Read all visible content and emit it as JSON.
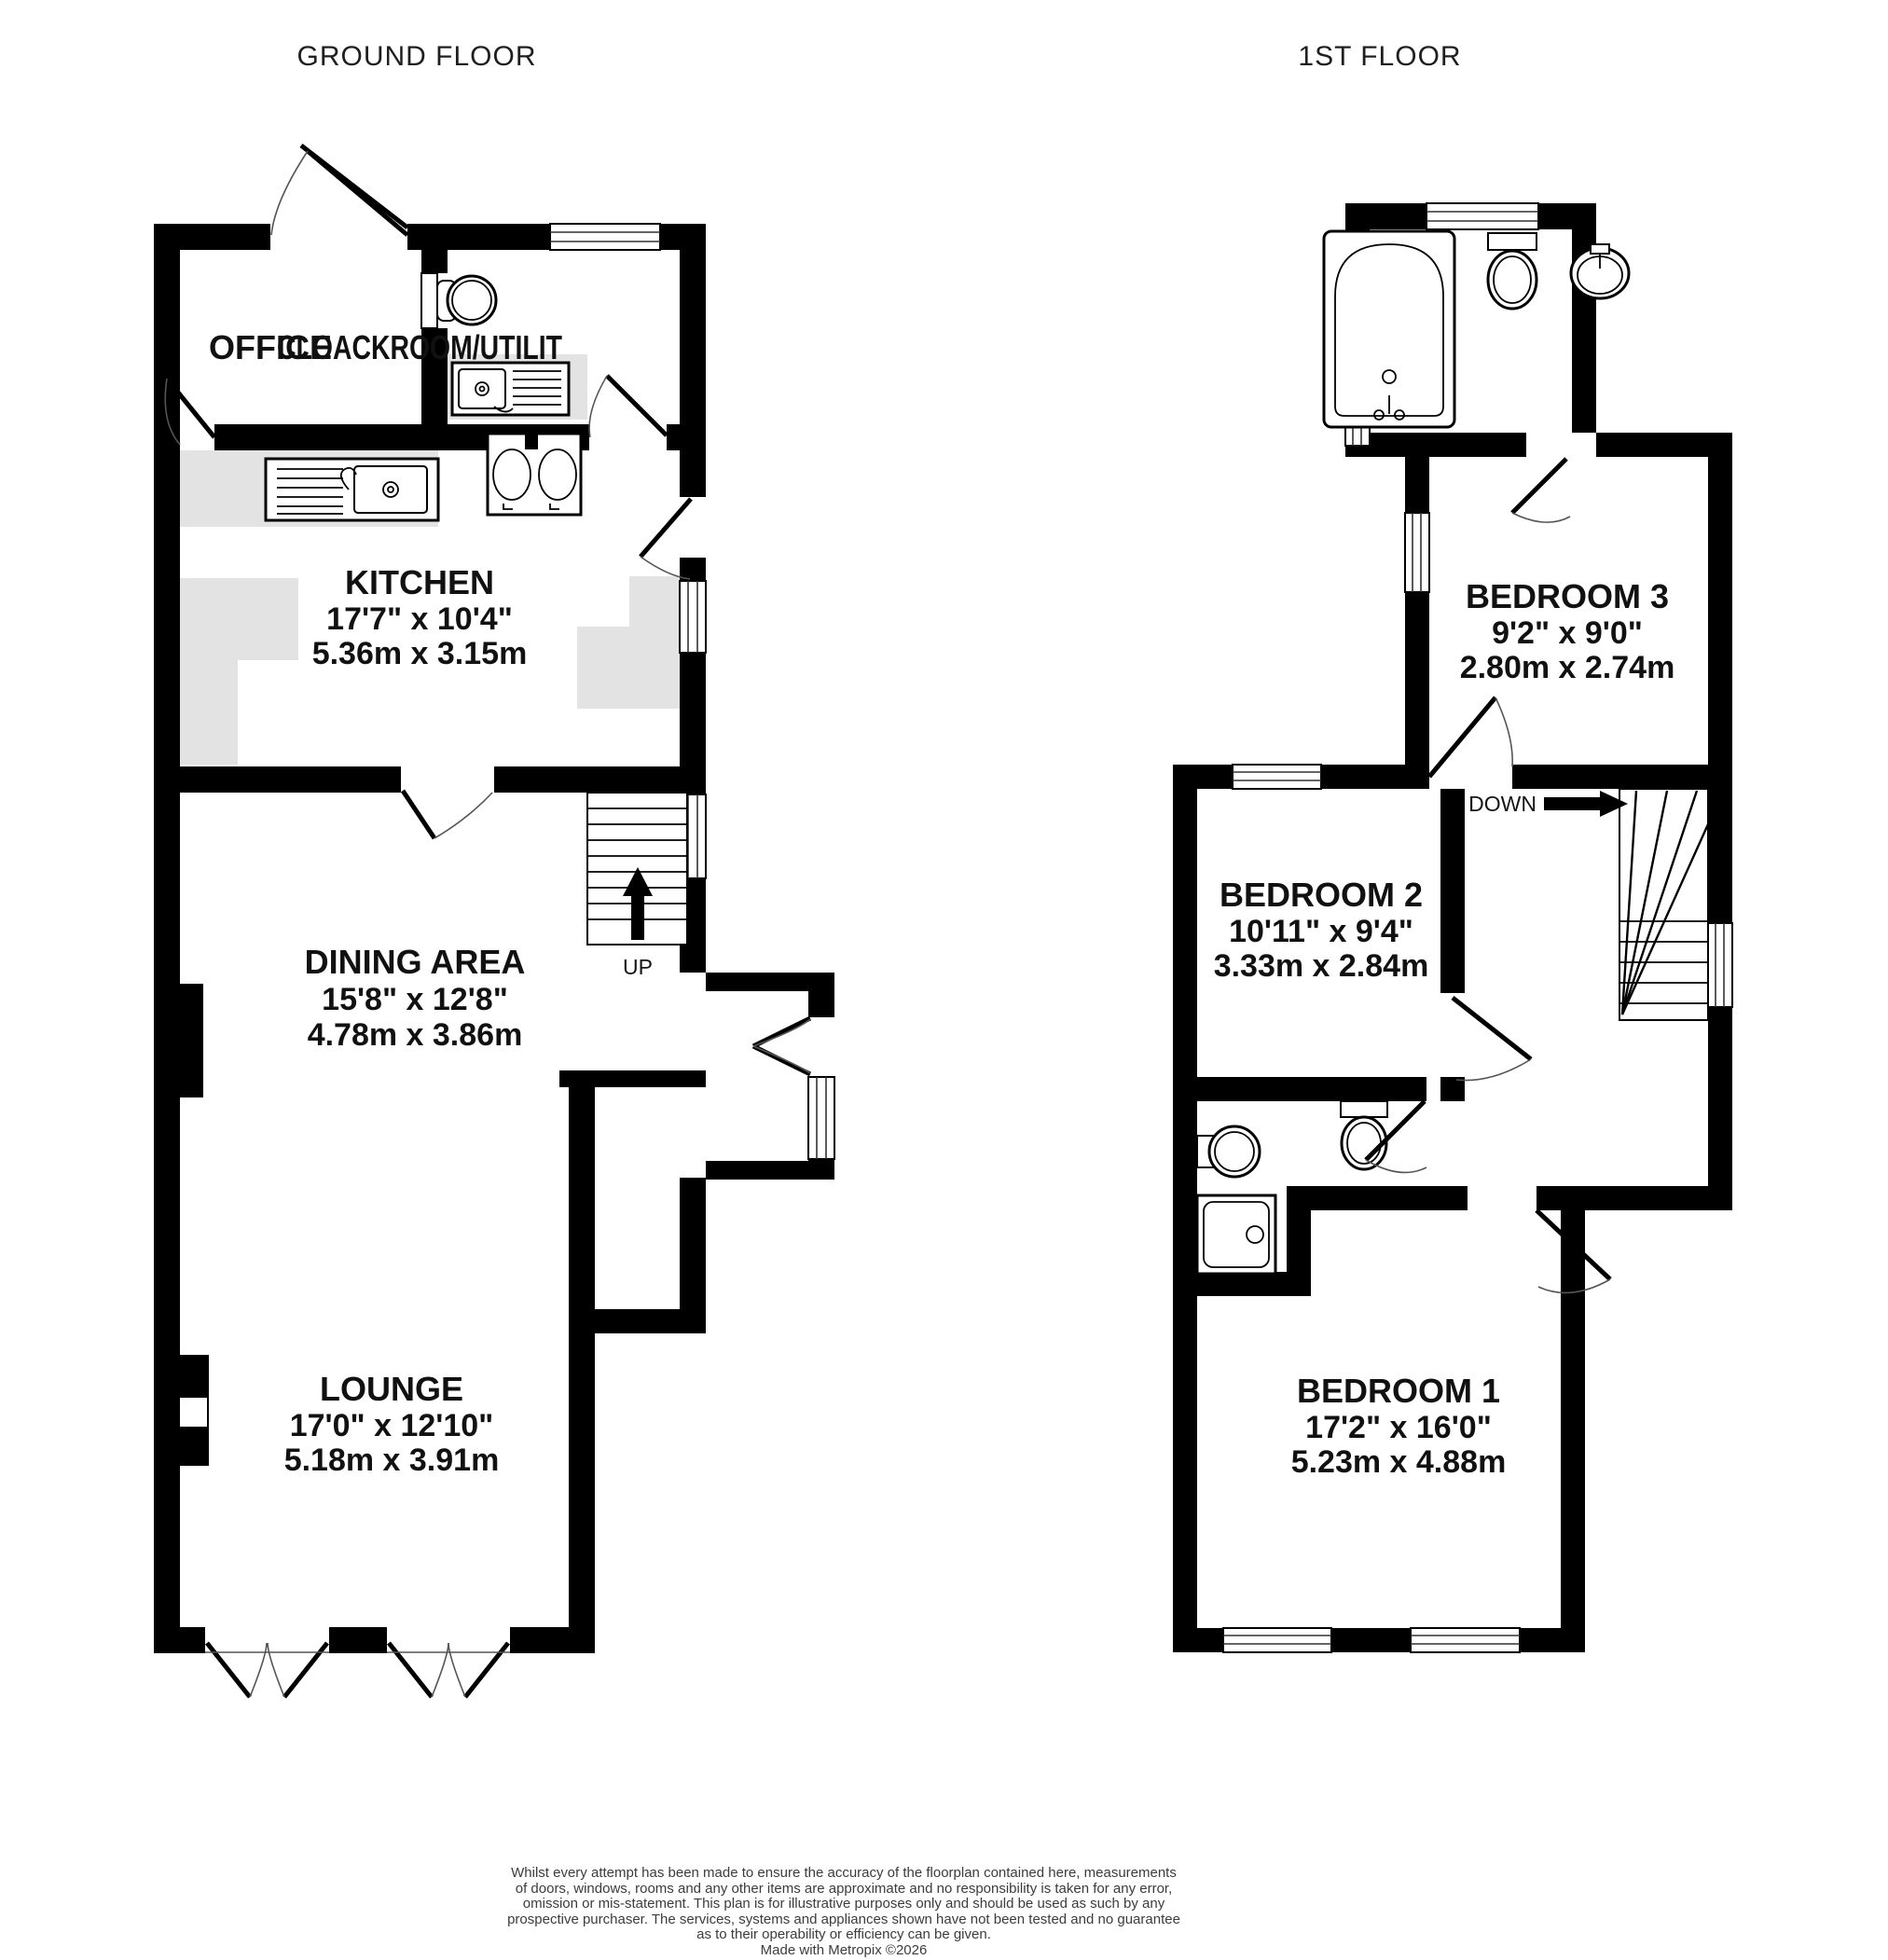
{
  "colors": {
    "wall": "#000000",
    "counter": "#e3e3e3",
    "door_arc": "#555555",
    "label_text": "#111111",
    "disclaimer_text": "#3c3c3c"
  },
  "floors": {
    "ground": {
      "title": "GROUND FLOOR",
      "stairs_label": "UP",
      "rooms": {
        "office": {
          "name": "OFFICE"
        },
        "cloakroom": {
          "name": "CLOACKROOM/UTILIT"
        },
        "kitchen": {
          "name": "KITCHEN",
          "imperial": "17'7\"  x 10'4\"",
          "metric": "5.36m  x 3.15m"
        },
        "dining": {
          "name": "DINING AREA",
          "imperial": "15'8\"  x 12'8\"",
          "metric": "4.78m  x 3.86m"
        },
        "lounge": {
          "name": "LOUNGE",
          "imperial": "17'0\"  x 12'10\"",
          "metric": "5.18m  x 3.91m"
        }
      }
    },
    "first": {
      "title": "1ST FLOOR",
      "stairs_label": "DOWN",
      "rooms": {
        "bedroom3": {
          "name": "BEDROOM 3",
          "imperial": "9'2\"  x 9'0\"",
          "metric": "2.80m  x 2.74m"
        },
        "bedroom2": {
          "name": "BEDROOM 2",
          "imperial": "10'11\"  x 9'4\"",
          "metric": "3.33m  x 2.84m"
        },
        "bedroom1": {
          "name": "BEDROOM 1",
          "imperial": "17'2\"  x 16'0\"",
          "metric": "5.23m  x 4.88m"
        }
      }
    }
  },
  "footer": {
    "lines": [
      "Whilst every attempt has been made to ensure the accuracy of the floorplan contained here, measurements",
      "of doors, windows, rooms and any other items are approximate and no responsibility is taken for any error,",
      "omission or mis-statement. This plan is for illustrative purposes only and should be used as such by any",
      "prospective purchaser. The services, systems and appliances shown have not been tested and no guarantee",
      "as to their operability or efficiency can be given."
    ],
    "credit": "Made with Metropix ©2026"
  }
}
